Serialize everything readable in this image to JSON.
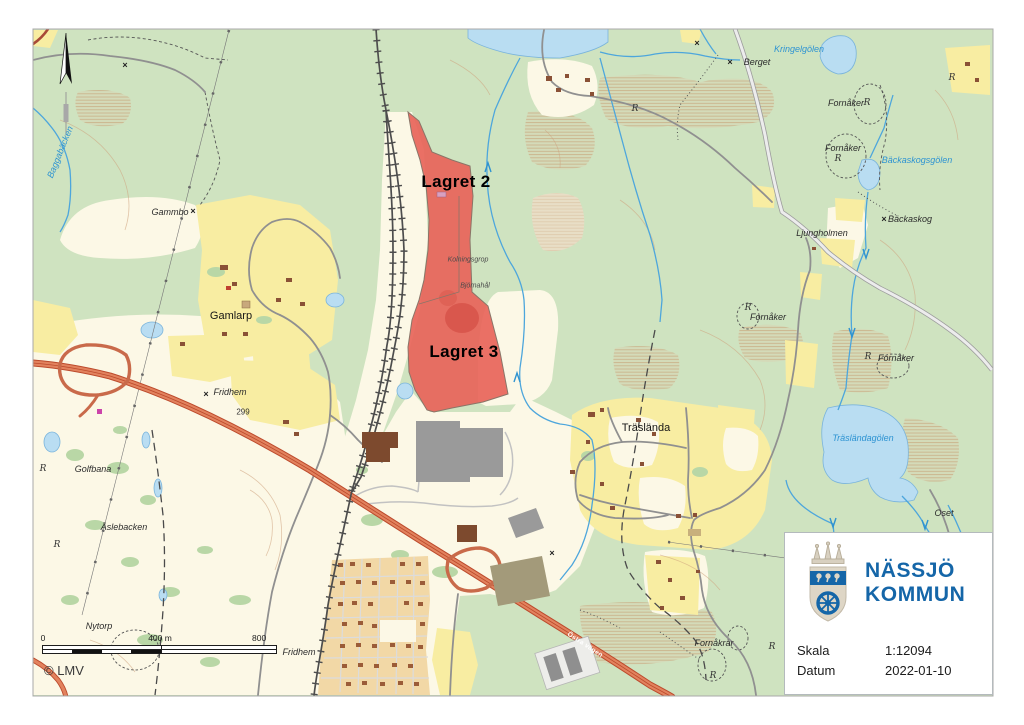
{
  "map": {
    "copyright": "© LMV",
    "scalebar": {
      "t0": "0",
      "t400": "400 m",
      "t800": "800 m"
    },
    "labels": [
      {
        "text": "Baggabäcken",
        "x": 60,
        "y": 152,
        "type": "water",
        "rot": -68
      },
      {
        "text": "Gammbo",
        "x": 170,
        "y": 212,
        "type": "nature"
      },
      {
        "text": "Gamlarp",
        "x": 231,
        "y": 316,
        "type": "place"
      },
      {
        "text": "Golfbana",
        "x": 93,
        "y": 469,
        "type": "nature"
      },
      {
        "text": "Åslebacken",
        "x": 124,
        "y": 527,
        "type": "nature"
      },
      {
        "text": "Nytorp",
        "x": 99,
        "y": 626,
        "type": "nature"
      },
      {
        "text": "Fridhem",
        "x": 299,
        "y": 652,
        "type": "nature"
      },
      {
        "text": "Fridhem",
        "x": 230,
        "y": 392,
        "type": "nature"
      },
      {
        "text": "299",
        "x": 243,
        "y": 412,
        "type": "num"
      },
      {
        "text": "Lagret 2",
        "x": 456,
        "y": 182,
        "type": "area"
      },
      {
        "text": "Lagret 3",
        "x": 464,
        "y": 352,
        "type": "area"
      },
      {
        "text": "Kolningsgrop",
        "x": 468,
        "y": 260,
        "type": "tiny"
      },
      {
        "text": "Björnahål",
        "x": 475,
        "y": 286,
        "type": "tiny"
      },
      {
        "text": "Träslända",
        "x": 646,
        "y": 428,
        "type": "place"
      },
      {
        "text": "Berget",
        "x": 757,
        "y": 62,
        "type": "nature"
      },
      {
        "text": "Kringelgölen",
        "x": 799,
        "y": 49,
        "type": "water"
      },
      {
        "text": "Fornåker",
        "x": 846,
        "y": 103,
        "type": "nature"
      },
      {
        "text": "Fornåker",
        "x": 843,
        "y": 148,
        "type": "nature"
      },
      {
        "text": "Bäckaskogsgölen",
        "x": 917,
        "y": 160,
        "type": "water"
      },
      {
        "text": "Ljungholmen",
        "x": 822,
        "y": 233,
        "type": "nature"
      },
      {
        "text": "Bäckaskog",
        "x": 910,
        "y": 219,
        "type": "nature"
      },
      {
        "text": "Fornåker",
        "x": 768,
        "y": 317,
        "type": "nature"
      },
      {
        "text": "Fornåker",
        "x": 896,
        "y": 358,
        "type": "nature"
      },
      {
        "text": "Träsländagölen",
        "x": 863,
        "y": 438,
        "type": "water"
      },
      {
        "text": "Oset",
        "x": 944,
        "y": 513,
        "type": "nature"
      },
      {
        "text": "Fornåkrar",
        "x": 714,
        "y": 643,
        "type": "nature"
      },
      {
        "text": "Östra vägen",
        "x": 585,
        "y": 645,
        "type": "road",
        "rot": 33
      }
    ],
    "markers": {
      "r_glyph": "R",
      "x_glyph": "×",
      "r_symbols": [
        [
          43,
          469
        ],
        [
          57,
          545
        ],
        [
          635,
          109
        ],
        [
          952,
          78
        ],
        [
          748,
          308
        ],
        [
          868,
          357
        ],
        [
          867,
          103
        ],
        [
          838,
          159
        ],
        [
          713,
          676
        ],
        [
          772,
          647
        ]
      ],
      "x_symbols": [
        [
          193,
          211
        ],
        [
          206,
          394
        ],
        [
          730,
          62
        ],
        [
          884,
          219
        ],
        [
          125,
          65
        ],
        [
          697,
          43
        ],
        [
          552,
          553
        ]
      ]
    },
    "highlight_areas": [
      "Lagret 2",
      "Lagret 3"
    ]
  },
  "infobox": {
    "org_line1": "NÄSSJÖ",
    "org_line2": "KOMMUN",
    "rows": [
      {
        "label": "Skala",
        "value": "1:12094"
      },
      {
        "label": "Datum",
        "value": "2022-01-10"
      }
    ]
  },
  "colors": {
    "brand_blue": "#1566a8",
    "parcel_red": "#e8645a",
    "forest_green": "#cfe3c0",
    "field_yellow": "#f8eda2",
    "water_blue": "#b9ddf2"
  }
}
